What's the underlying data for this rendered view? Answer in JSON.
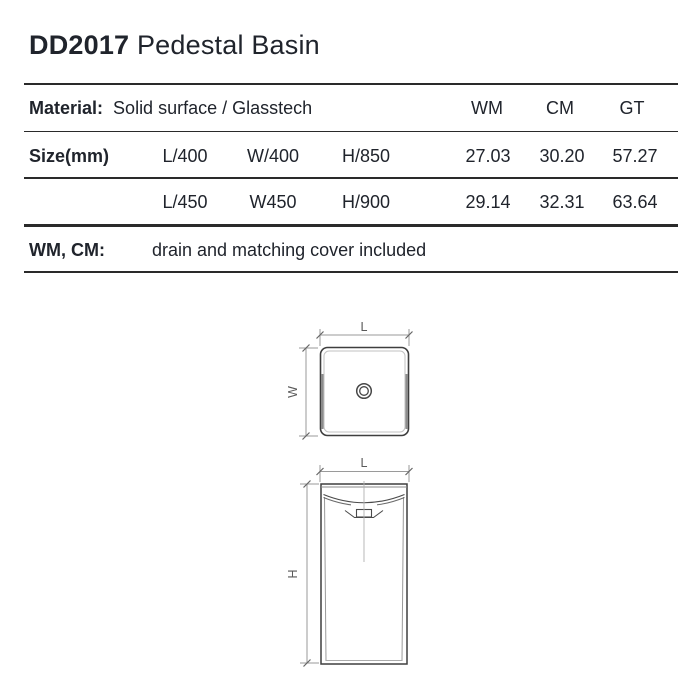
{
  "header": {
    "model": "DD2017",
    "product_name": "Pedestal Basin"
  },
  "spec_table": {
    "material_label": "Material:",
    "material_value": "Solid surface / Glasstech",
    "finish_columns": [
      "WM",
      "CM",
      "GT"
    ],
    "size_label": "Size(mm)",
    "rows": [
      {
        "dims": [
          "L/400",
          "W/400",
          "H/850"
        ],
        "values": [
          "27.03",
          "30.20",
          "57.27"
        ]
      },
      {
        "dims": [
          "L/450",
          "W450",
          "H/900"
        ],
        "values": [
          "29.14",
          "32.31",
          "63.64"
        ]
      }
    ],
    "note_label": "WM, CM:",
    "note_text": "drain and matching cover included"
  },
  "drawings": {
    "top_view": {
      "length_label": "L",
      "width_label": "W"
    },
    "front_view": {
      "length_label": "L",
      "height_label": "H"
    }
  },
  "colors": {
    "text": "#20242c",
    "table_rule": "#2a2a2a",
    "outline": "#3f3f3f",
    "dim_line": "#9a9a9a",
    "dim_label": "#5a5a5a",
    "background": "#ffffff"
  }
}
